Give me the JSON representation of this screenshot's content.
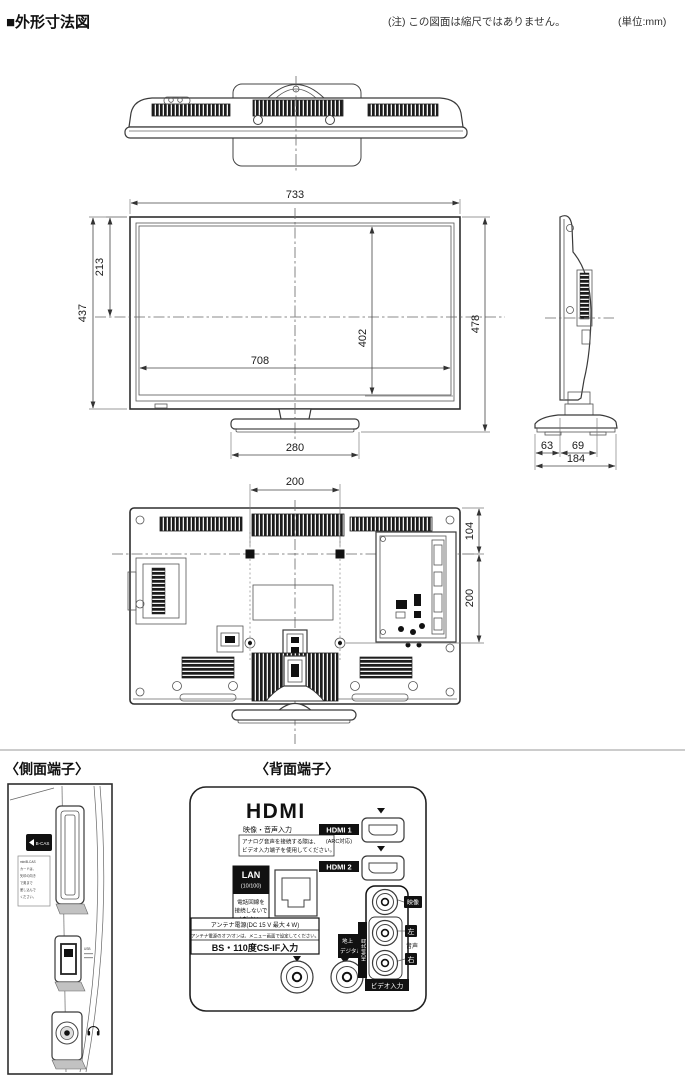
{
  "header": {
    "title": "■外形寸法図",
    "note": "(注) この図面は縮尺ではありません。",
    "unit": "(単位:mm)"
  },
  "sections": {
    "side_terminal": "〈側面端子〉",
    "rear_terminal": "〈背面端子〉"
  },
  "dimensions": {
    "front": {
      "width": "733",
      "height": "437",
      "top_to_center": "213",
      "screen_width": "708",
      "screen_height": "402",
      "total_height": "478",
      "stand_width": "280"
    },
    "side": {
      "front": "63",
      "back": "69",
      "total": "184"
    },
    "rear": {
      "vesa_width": "200",
      "top_offset": "104",
      "vesa_height": "200"
    }
  },
  "side_panel": {
    "bcas_label": "B-CAS",
    "note_lines": [
      "miniB-CAS",
      "カードは、",
      "矢印の向き",
      "で奥まで",
      "差し込んで",
      "ください。"
    ],
    "usb_label": "USB"
  },
  "rear_panel": {
    "hdmi_logo": "HDMI",
    "av_input_label": "映像・音声入力",
    "analog_note": [
      "アナログ音声を接続する際は、",
      "ビデオ入力端子を使用してください。"
    ],
    "hdmi1_label": "HDMI 1",
    "hdmi1_sub": "(ARC対応)",
    "hdmi2_label": "HDMI 2",
    "lan_label": "LAN",
    "lan_sub": "(10/100)",
    "lan_note": [
      "電話回線を",
      "接続しないで",
      "ください。"
    ],
    "antenna_note1": "アンテナ電源(DC 15 V 最大 4 W)",
    "antenna_note2": "アンテナ電源のオフ/オンは、メニュー画面で設定してください。",
    "antenna_input": "BS・110度CS-IF入力",
    "terrestrial": [
      "地上",
      "デジタル入力"
    ],
    "hdmi_shared": "HDMI共用",
    "video_input": "ビデオ入力",
    "jack_labels": {
      "video": "映像",
      "audio": "音声",
      "left": "左",
      "right": "右"
    }
  }
}
